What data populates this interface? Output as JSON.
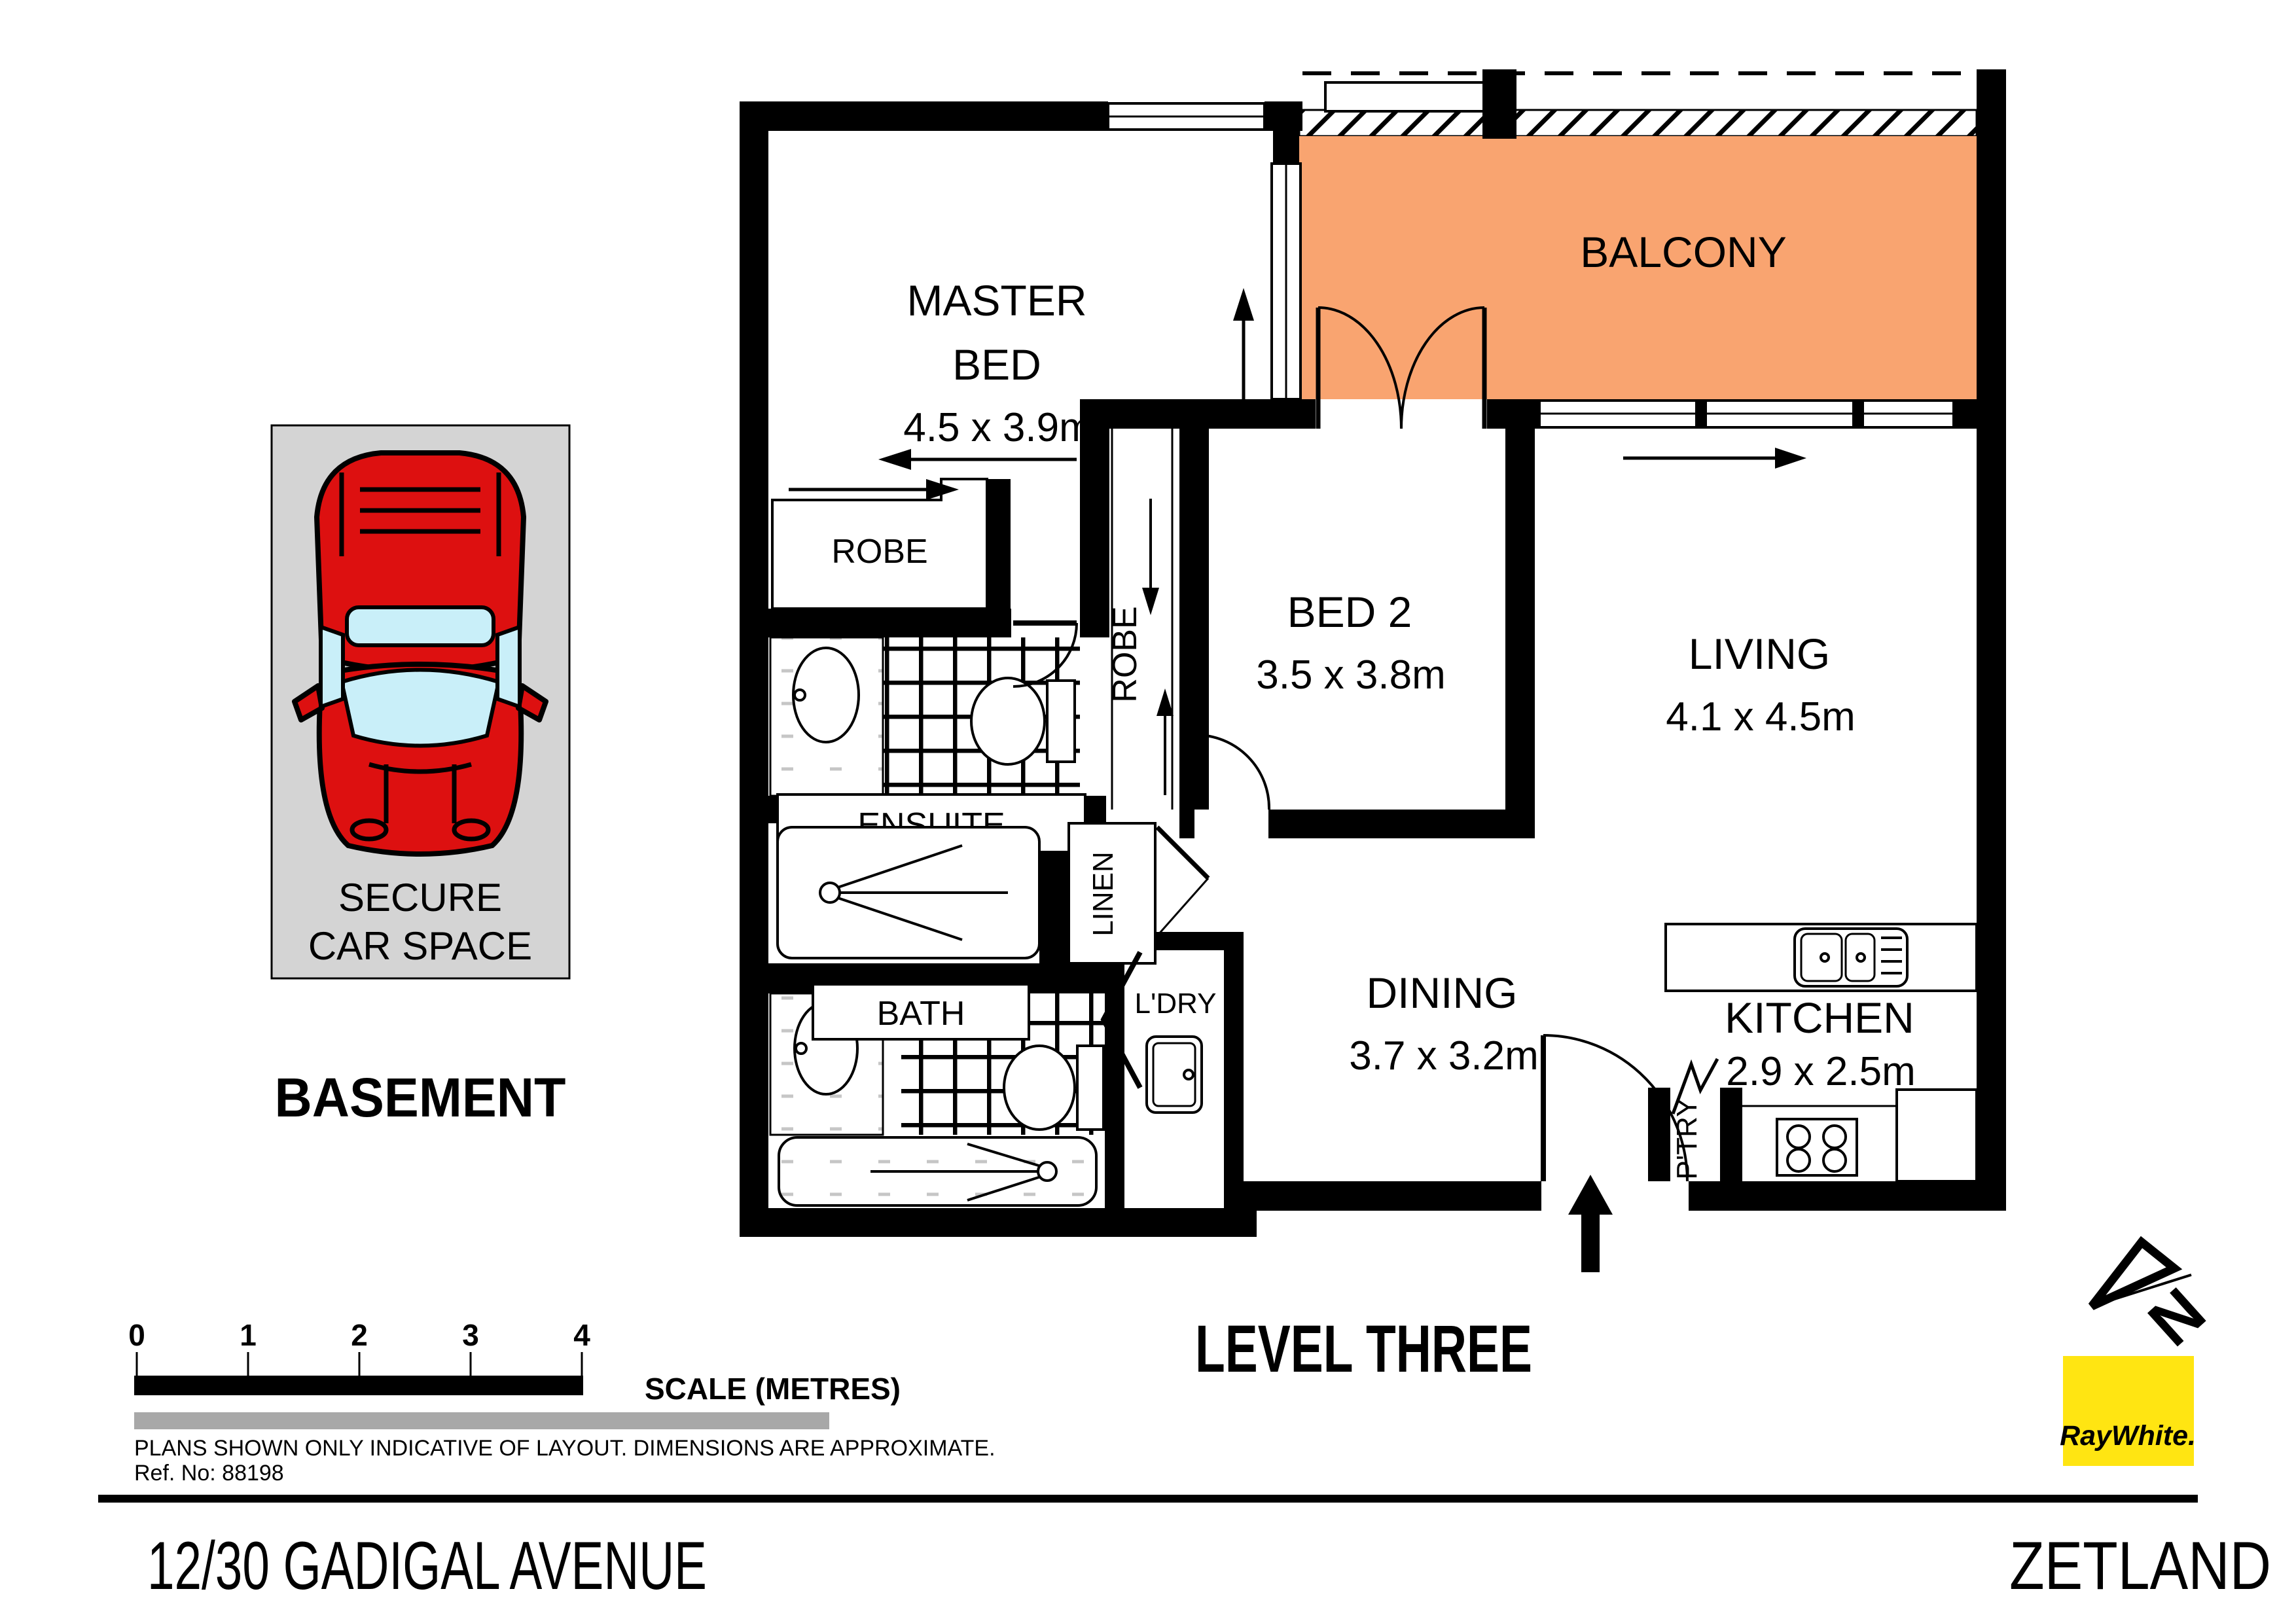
{
  "plan": {
    "title": "LEVEL THREE",
    "rooms": {
      "master": {
        "line1": "MASTER",
        "line2": "BED",
        "dims": "4.5 x 3.9m"
      },
      "bed2": {
        "name": "BED 2",
        "dims": "3.5 x 3.8m"
      },
      "living": {
        "name": "LIVING",
        "dims": "4.1 x 4.5m"
      },
      "dining": {
        "name": "DINING",
        "dims": "3.7 x 3.2m"
      },
      "kitchen": {
        "name": "KITCHEN",
        "dims": "2.9 x 2.5m"
      },
      "balcony": {
        "name": "BALCONY"
      }
    },
    "labels": {
      "master_robe": "ROBE",
      "bed2_robe": "ROBE",
      "ensuite": "ENSUITE",
      "bath": "BATH",
      "linen": "LINEN",
      "laundry": "L'DRY",
      "pantry": "P'TRY"
    }
  },
  "carspace": {
    "line1": "SECURE",
    "line2": "CAR SPACE",
    "area": "BASEMENT"
  },
  "scalebar": {
    "ticks": [
      "0",
      "1",
      "2",
      "3",
      "4"
    ],
    "label": "SCALE (METRES)"
  },
  "footer": {
    "disclaimer": "PLANS SHOWN ONLY INDICATIVE OF LAYOUT.  DIMENSIONS ARE APPROXIMATE.",
    "ref": "Ref. No: 88198",
    "address": "12/30 GADIGAL AVENUE",
    "suburb": "ZETLAND"
  },
  "branding": {
    "agency": "RayWhite.",
    "compass": "N"
  },
  "colors": {
    "balcony": "#F9A470",
    "carspace_bg": "#D4D4D4",
    "car_body": "#DD1010",
    "car_glass": "#C9EFF9",
    "agency_bg": "#FFE512",
    "agency_text": "#5A5C5E",
    "scale_gray": "#A8A8A8"
  }
}
